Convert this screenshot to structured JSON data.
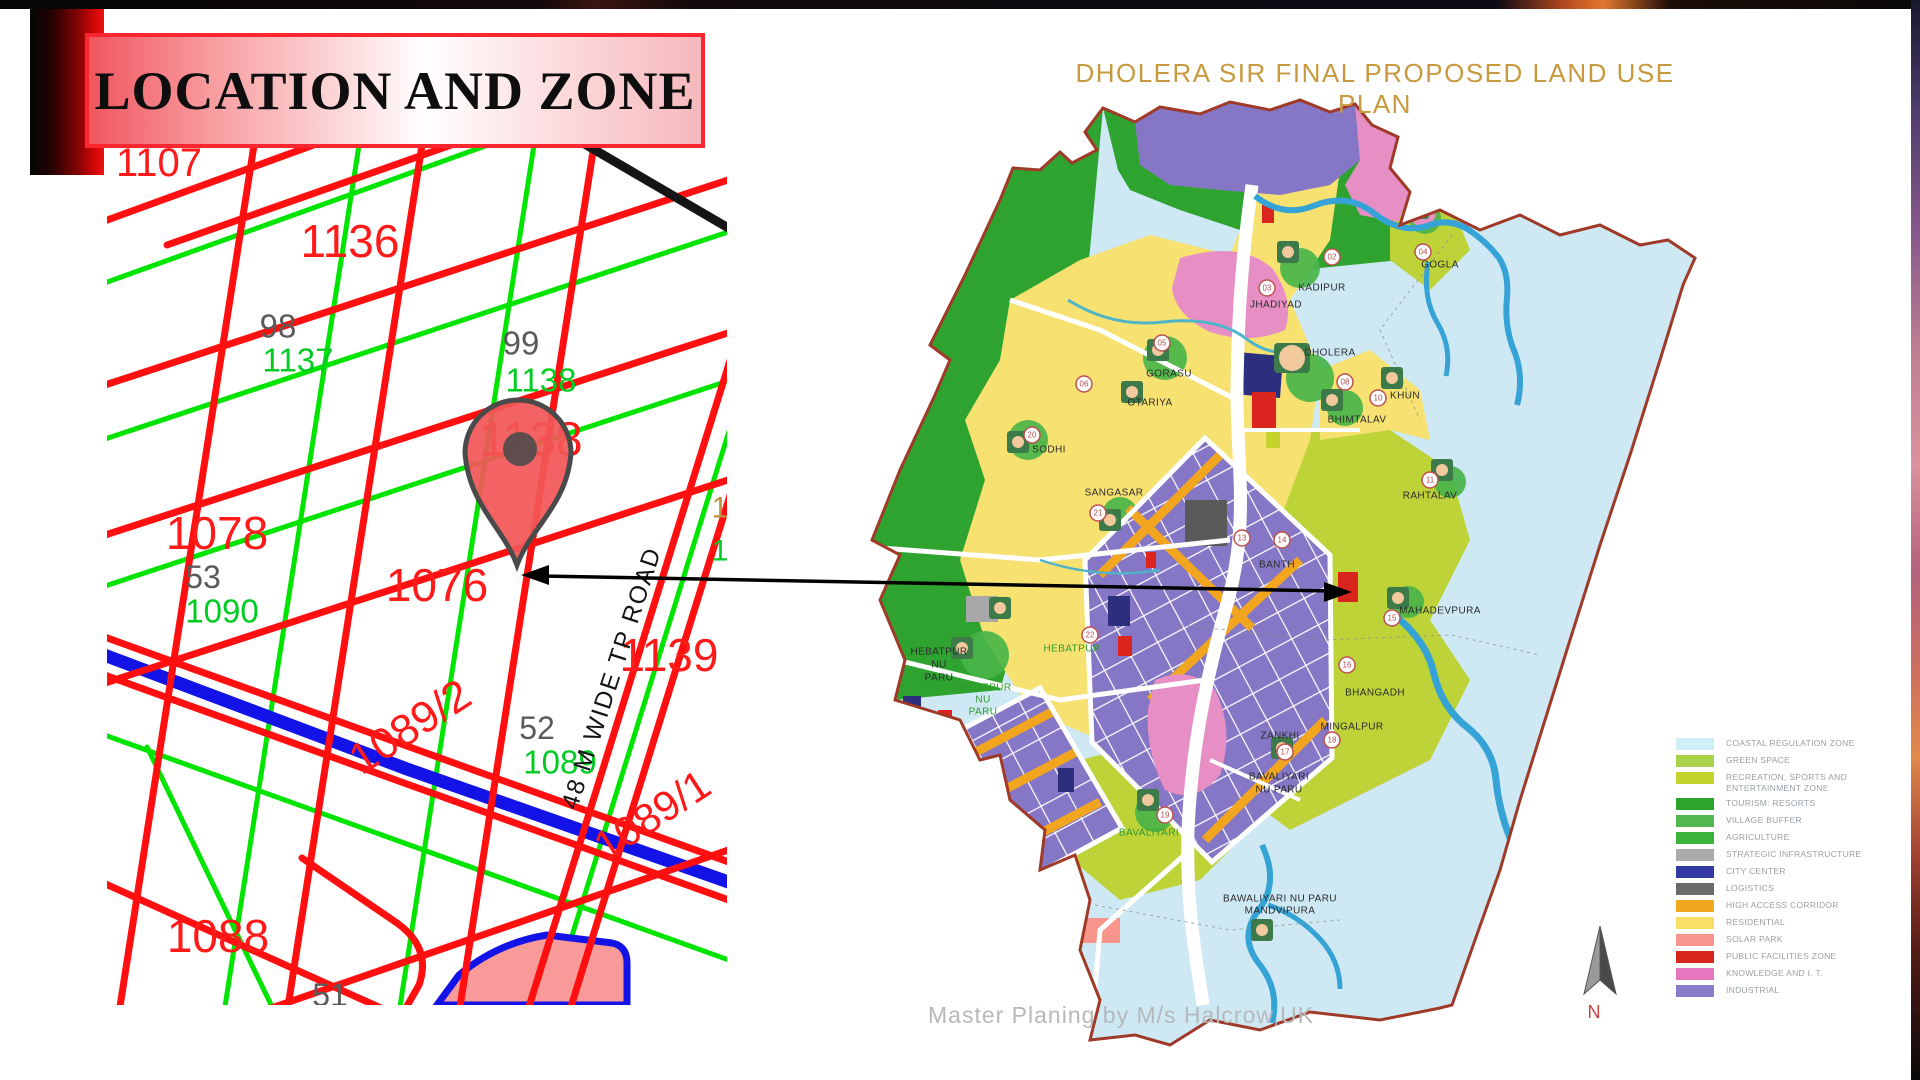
{
  "slide": {
    "title": "LOCATION AND ZONE"
  },
  "left_map": {
    "road_label": "48 M WIDE TP ROAD",
    "parcels": [
      {
        "label": "1107",
        "color": "#ff1a1a"
      },
      {
        "label": "1136",
        "color": "#ff1a1a"
      },
      {
        "label": "98",
        "color": "#5a5a5a"
      },
      {
        "label": "1137",
        "color": "#00cc22"
      },
      {
        "label": "99",
        "color": "#5a5a5a"
      },
      {
        "label": "1138",
        "color": "#00cc22"
      },
      {
        "label": "1138",
        "color": "#ff1a1a"
      },
      {
        "label": "1078",
        "color": "#ff1a1a"
      },
      {
        "label": "53",
        "color": "#5a5a5a"
      },
      {
        "label": "1090",
        "color": "#00cc22"
      },
      {
        "label": "1076",
        "color": "#ff1a1a"
      },
      {
        "label": "1139",
        "color": "#ff1a1a"
      },
      {
        "label": "1089/2",
        "color": "#ff1a1a"
      },
      {
        "label": "52",
        "color": "#5a5a5a"
      },
      {
        "label": "1089",
        "color": "#00cc22"
      },
      {
        "label": "1089/1",
        "color": "#ff1a1a"
      },
      {
        "label": "1088",
        "color": "#ff1a1a"
      },
      {
        "label": "51",
        "color": "#5a5a5a"
      }
    ],
    "edge_digits": [
      "1",
      "1"
    ]
  },
  "right_map": {
    "title": "DHOLERA SIR FINAL PROPOSED LAND USE PLAN",
    "credit": "Master Planing by M/s Halcrow,UK",
    "compass": "N",
    "places": [
      {
        "label": "KADIPUR"
      },
      {
        "label": "DHOLERA"
      },
      {
        "label": "GORASU"
      },
      {
        "label": "OTARIYA"
      },
      {
        "label": "KHUN"
      },
      {
        "label": "BHIMTALAV"
      },
      {
        "label": "SODHI"
      },
      {
        "label": "SANGASAR"
      },
      {
        "label": "RAHTALAV"
      },
      {
        "label": "GOGLA"
      },
      {
        "label": "JHADIYAD"
      },
      {
        "label": "MAHADEVPURA"
      },
      {
        "label": "BHANGADH"
      },
      {
        "label": "ZANKHI"
      },
      {
        "label": "MINGALPUR"
      },
      {
        "label": "BANTH"
      },
      {
        "label": "HEBATPUR",
        "label2": "NU",
        "label3": "PARU"
      },
      {
        "label": "HEBATPUR",
        "label2": "NU",
        "label3": "PARU"
      },
      {
        "label": "HEBATPUR"
      },
      {
        "label": "BAVALIYARI",
        "label2": "NU PARU"
      },
      {
        "label": "BAVALIYARI"
      },
      {
        "label": "BAWALIYARI NU PARU",
        "label2": "MANDVIPURA"
      }
    ],
    "markers": [
      "02",
      "03",
      "04",
      "05",
      "06",
      "08",
      "10",
      "11",
      "13",
      "14",
      "15",
      "16",
      "17",
      "18",
      "19",
      "20",
      "21",
      "22"
    ],
    "legend": {
      "items": [
        {
          "label": "COASTAL REGULATION ZONE",
          "color": "#cfeef5"
        },
        {
          "label": "GREEN SPACE",
          "color": "#a8d24a"
        },
        {
          "label": "RECREATION, SPORTS AND",
          "label2": "ENTERTAINMENT ZONE",
          "color": "#c5d32e"
        },
        {
          "label": "TOURISM: RESORTS",
          "color": "#2ba52b"
        },
        {
          "label": "VILLAGE BUFFER",
          "color": "#52b852"
        },
        {
          "label": "AGRICULTURE",
          "color": "#3cb43c"
        },
        {
          "label": "STRATEGIC INFRASTRUCTURE",
          "color": "#ababab"
        },
        {
          "label": "CITY CENTER",
          "color": "#3239a0"
        },
        {
          "label": "LOGISTICS",
          "color": "#6b6b6b"
        },
        {
          "label": "HIGH ACCESS CORRIDOR",
          "color": "#f0a81e"
        },
        {
          "label": "RESIDENTIAL",
          "color": "#f8e068"
        },
        {
          "label": "SOLAR PARK",
          "color": "#f8948b"
        },
        {
          "label": "PUBLIC FACILITIES ZONE",
          "color": "#d9251d"
        },
        {
          "label": "KNOWLEDGE AND I. T.",
          "color": "#e778c0"
        },
        {
          "label": "INDUSTRIAL",
          "color": "#8a7cc8"
        }
      ]
    }
  },
  "palette": {
    "banner_red": "#fa2630",
    "parcel_red": "#ff1a1a",
    "parcel_green": "#00cc22",
    "parcel_gray": "#5a5a5a",
    "canal_blue": "#1313e8",
    "map_boundary": "#a03a28",
    "title_gold": "#c89a3f",
    "pin_red": "#f25757"
  }
}
